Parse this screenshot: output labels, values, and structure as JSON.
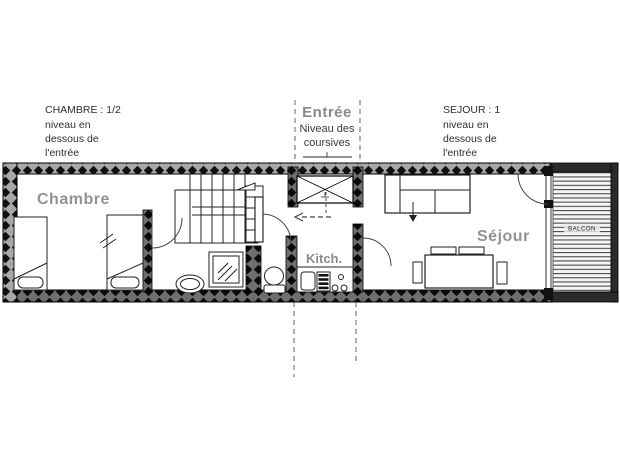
{
  "plan": {
    "annotations": {
      "chambre": {
        "lines": [
          "CHAMBRE : 1/2",
          "niveau en",
          "dessous de",
          "l'entrée"
        ]
      },
      "entree": {
        "title": "Entrée",
        "lines": [
          "Niveau des",
          "coursives"
        ]
      },
      "sejour": {
        "lines": [
          "SEJOUR : 1",
          "niveau en",
          "dessous de",
          "l'entrée"
        ]
      }
    },
    "room_labels": {
      "chambre": "Chambre",
      "sejour": "Séjour",
      "kitchen": "Kitch.",
      "balcony": "BALCON"
    },
    "colors": {
      "wall_diamond": "#111111",
      "wall_base": "#a8a8a8",
      "room_label_gray": "#929292",
      "annotation_text": "#2f2f2f",
      "line_color": "#222222",
      "background": "#ffffff"
    }
  }
}
